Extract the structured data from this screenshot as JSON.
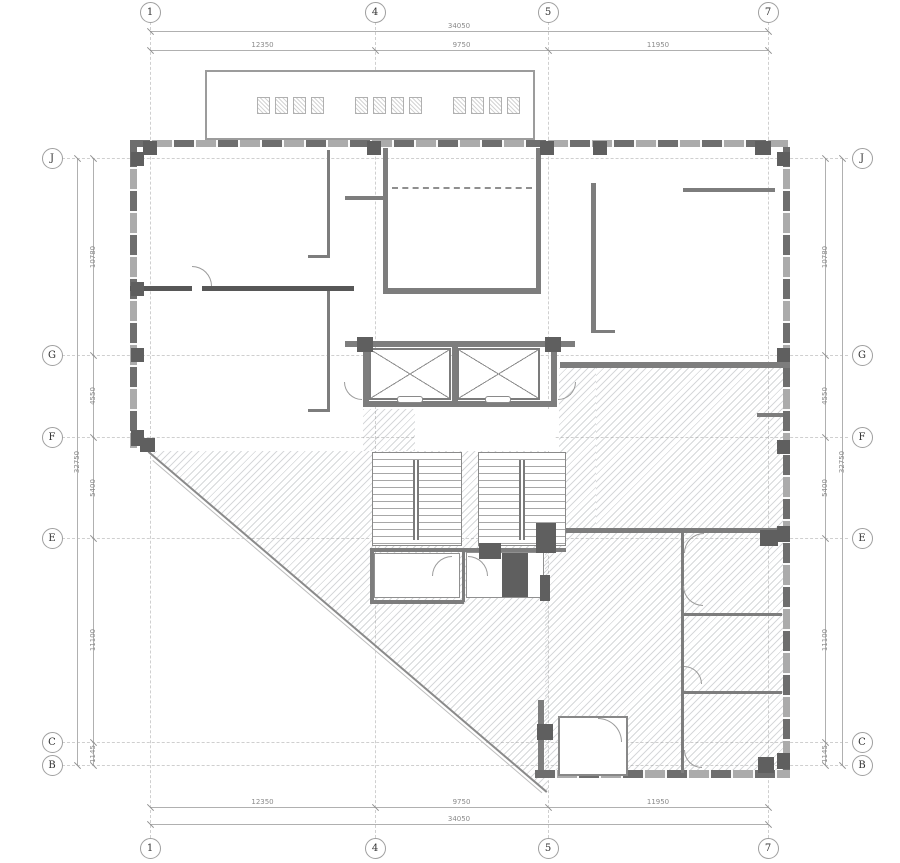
{
  "drawing": {
    "type": "architectural floor plan",
    "canopy_label": {
      "note": "three groups of stenciled outline characters (illegible)",
      "glyph_groups": [
        4,
        4,
        4
      ]
    }
  },
  "grid": {
    "columns": [
      {
        "label": "1",
        "x": 150
      },
      {
        "label": "4",
        "x": 375
      },
      {
        "label": "5",
        "x": 548
      },
      {
        "label": "7",
        "x": 768
      }
    ],
    "rows": [
      {
        "label": "J",
        "y": 158
      },
      {
        "label": "G",
        "y": 355
      },
      {
        "label": "F",
        "y": 437
      },
      {
        "label": "E",
        "y": 538
      },
      {
        "label": "C",
        "y": 742
      },
      {
        "label": "B",
        "y": 765
      }
    ]
  },
  "dimensions": {
    "top": {
      "overall": "34050",
      "segments": [
        "12350",
        "9750",
        "11950"
      ]
    },
    "bottom": {
      "overall": "34050",
      "segments": [
        "12350",
        "9750",
        "11950"
      ]
    },
    "left": {
      "overall": "32750",
      "segments": [
        "10780",
        "4550",
        "5400",
        "11100",
        "1145"
      ]
    },
    "right": {
      "overall": "32750",
      "segments": [
        "10780",
        "4550",
        "5400",
        "11100",
        "1145"
      ]
    }
  },
  "colors": {
    "wall": "#7d7d7d",
    "wall_dark": "#575757",
    "column": "#5f5f5f",
    "hatch": "#94999d",
    "grid_line": "#cfcfcf",
    "dimension_text": "#8a8a8a",
    "bubble_border": "#9f9f9f"
  }
}
